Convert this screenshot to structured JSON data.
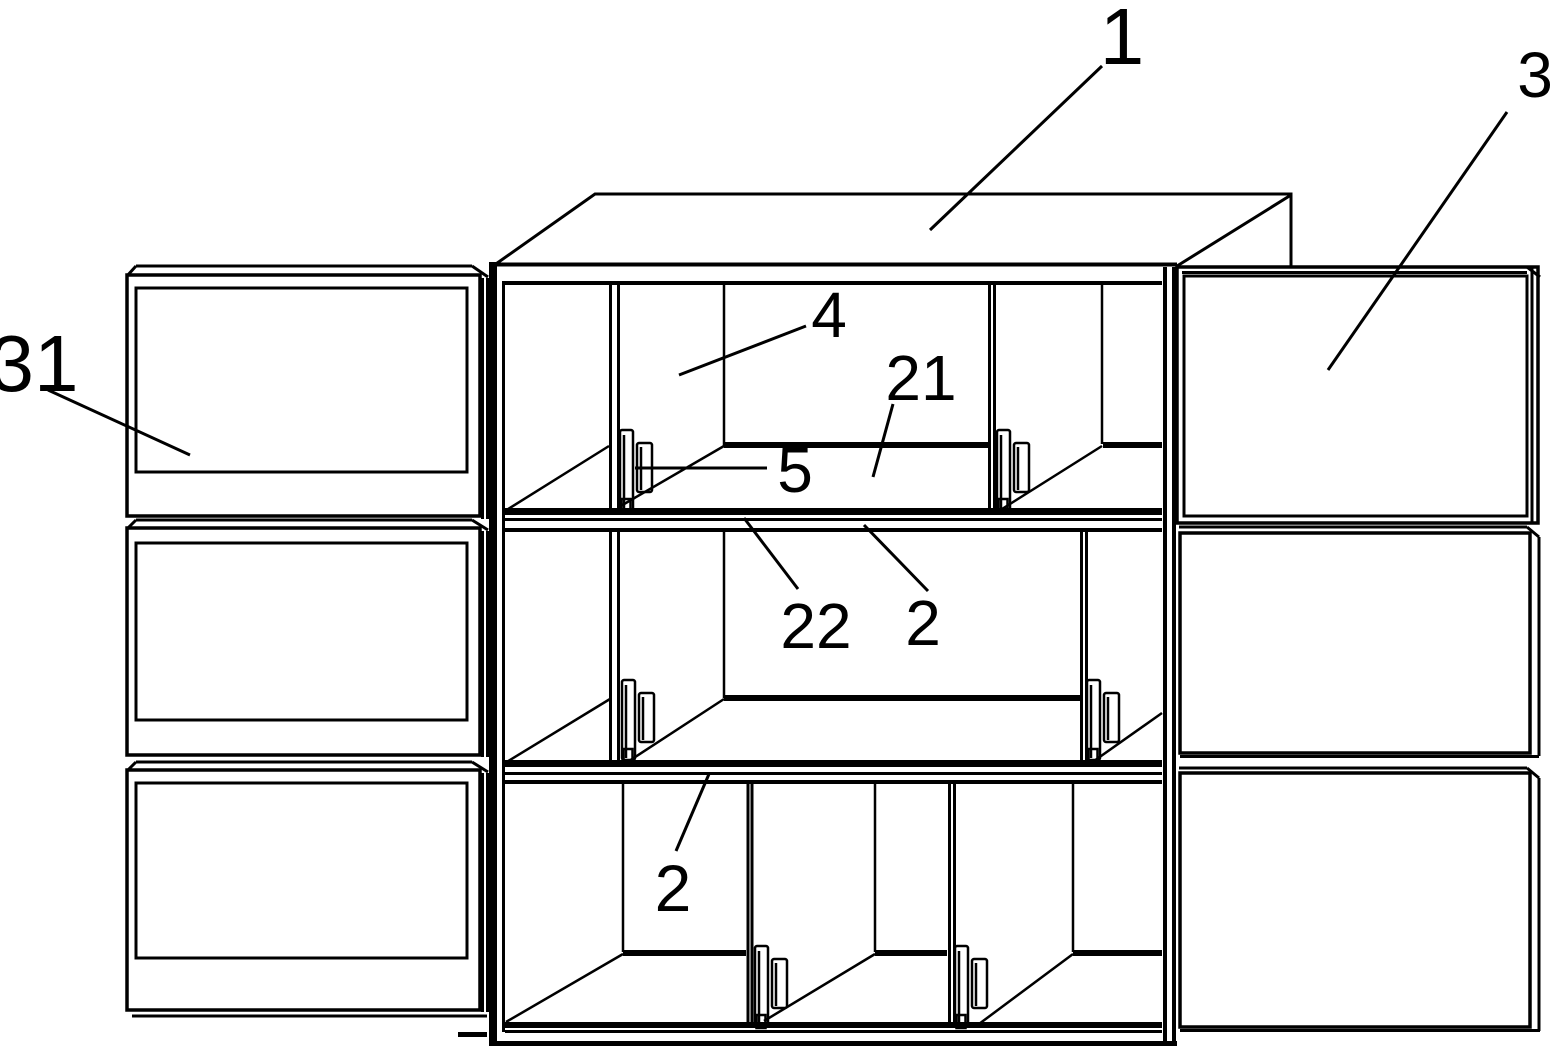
{
  "diagram": {
    "kind": "patent-style line drawing",
    "subject": "storage cabinet with shelves, side panels and retaining clips",
    "background_color": "#ffffff",
    "line_color": "#000000",
    "callouts": [
      {
        "ref": "1",
        "points_to": "cabinet-top-panel"
      },
      {
        "ref": "3",
        "points_to": "right-side-panel-stack"
      },
      {
        "ref": "31",
        "points_to": "left-side-panel"
      },
      {
        "ref": "4",
        "points_to": "compartment-back-wall"
      },
      {
        "ref": "21",
        "points_to": "shelf-top-surface"
      },
      {
        "ref": "5",
        "points_to": "retaining-clip"
      },
      {
        "ref": "22",
        "points_to": "shelf-front-edge"
      },
      {
        "ref": "2",
        "points_to": "middle-shelf-board"
      },
      {
        "ref": "2",
        "points_to": "bottom-shelf-board"
      }
    ]
  }
}
